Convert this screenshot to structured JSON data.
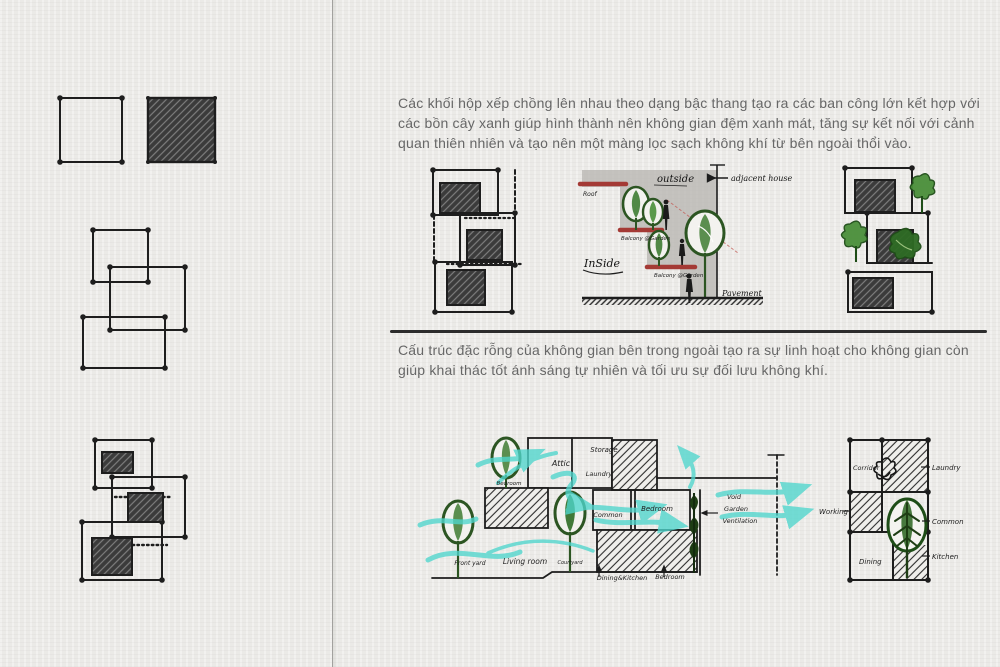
{
  "page": {
    "paragraph_1": "Các khối hộp xếp chồng lên nhau theo dạng bậc thang tạo ra các ban công lớn kết hợp với các bồn cây xanh giúp hình thành nên không gian đệm xanh mát, tăng sự kết nối với cảnh quan thiên nhiên và tạo nên một màng lọc sạch không khí từ bên ngoài thổi vào.",
    "paragraph_2": "Cấu trúc đặc rỗng của không gian bên trong ngoài tạo ra sự linh hoạt cho không gian còn giúp khai thác tốt ánh sáng tự nhiên và tối ưu sự đối lưu không khí."
  },
  "section_sketch": {
    "labels": {
      "outside": "outside",
      "adjacent_house": "adjacent house",
      "roof": "Roof",
      "balcony_garden_upper": "Balcony @Garden",
      "balcony_garden_lower": "Balcony @Garden",
      "inside": "InSide",
      "pavement": "Pavement"
    }
  },
  "airflow_sketch": {
    "labels": {
      "attic": "Attic",
      "storage": "Storage",
      "laundry": "Laundry",
      "bedroom_upper": "Bedroom",
      "common": "Common",
      "bedroom_middle": "Bedroom",
      "void_label": "Void",
      "garden": "Garden",
      "ventilation": "Ventilation",
      "front_yard": "Front yard",
      "living_room": "Living room",
      "courtyard": "Courtyard",
      "dining_kitchen": "Dining&Kitchen",
      "bedroom_lower": "Bedroom"
    }
  },
  "plan_sketch": {
    "labels": {
      "corridor": "Corridor",
      "laundry": "Laundry",
      "working": "Working",
      "common": "Common",
      "dining": "Dining",
      "kitchen": "Kitchen"
    }
  },
  "colors": {
    "paper": "#ebeae7",
    "ink": "#1e1e1e",
    "body_text": "#676767",
    "balcony_red": "#a43a35",
    "tree_green_dark": "#2c5522",
    "tree_green": "#3f7d33",
    "airflow_cyan": "#4fd6cd",
    "wash_gray": "#b5b3af"
  }
}
